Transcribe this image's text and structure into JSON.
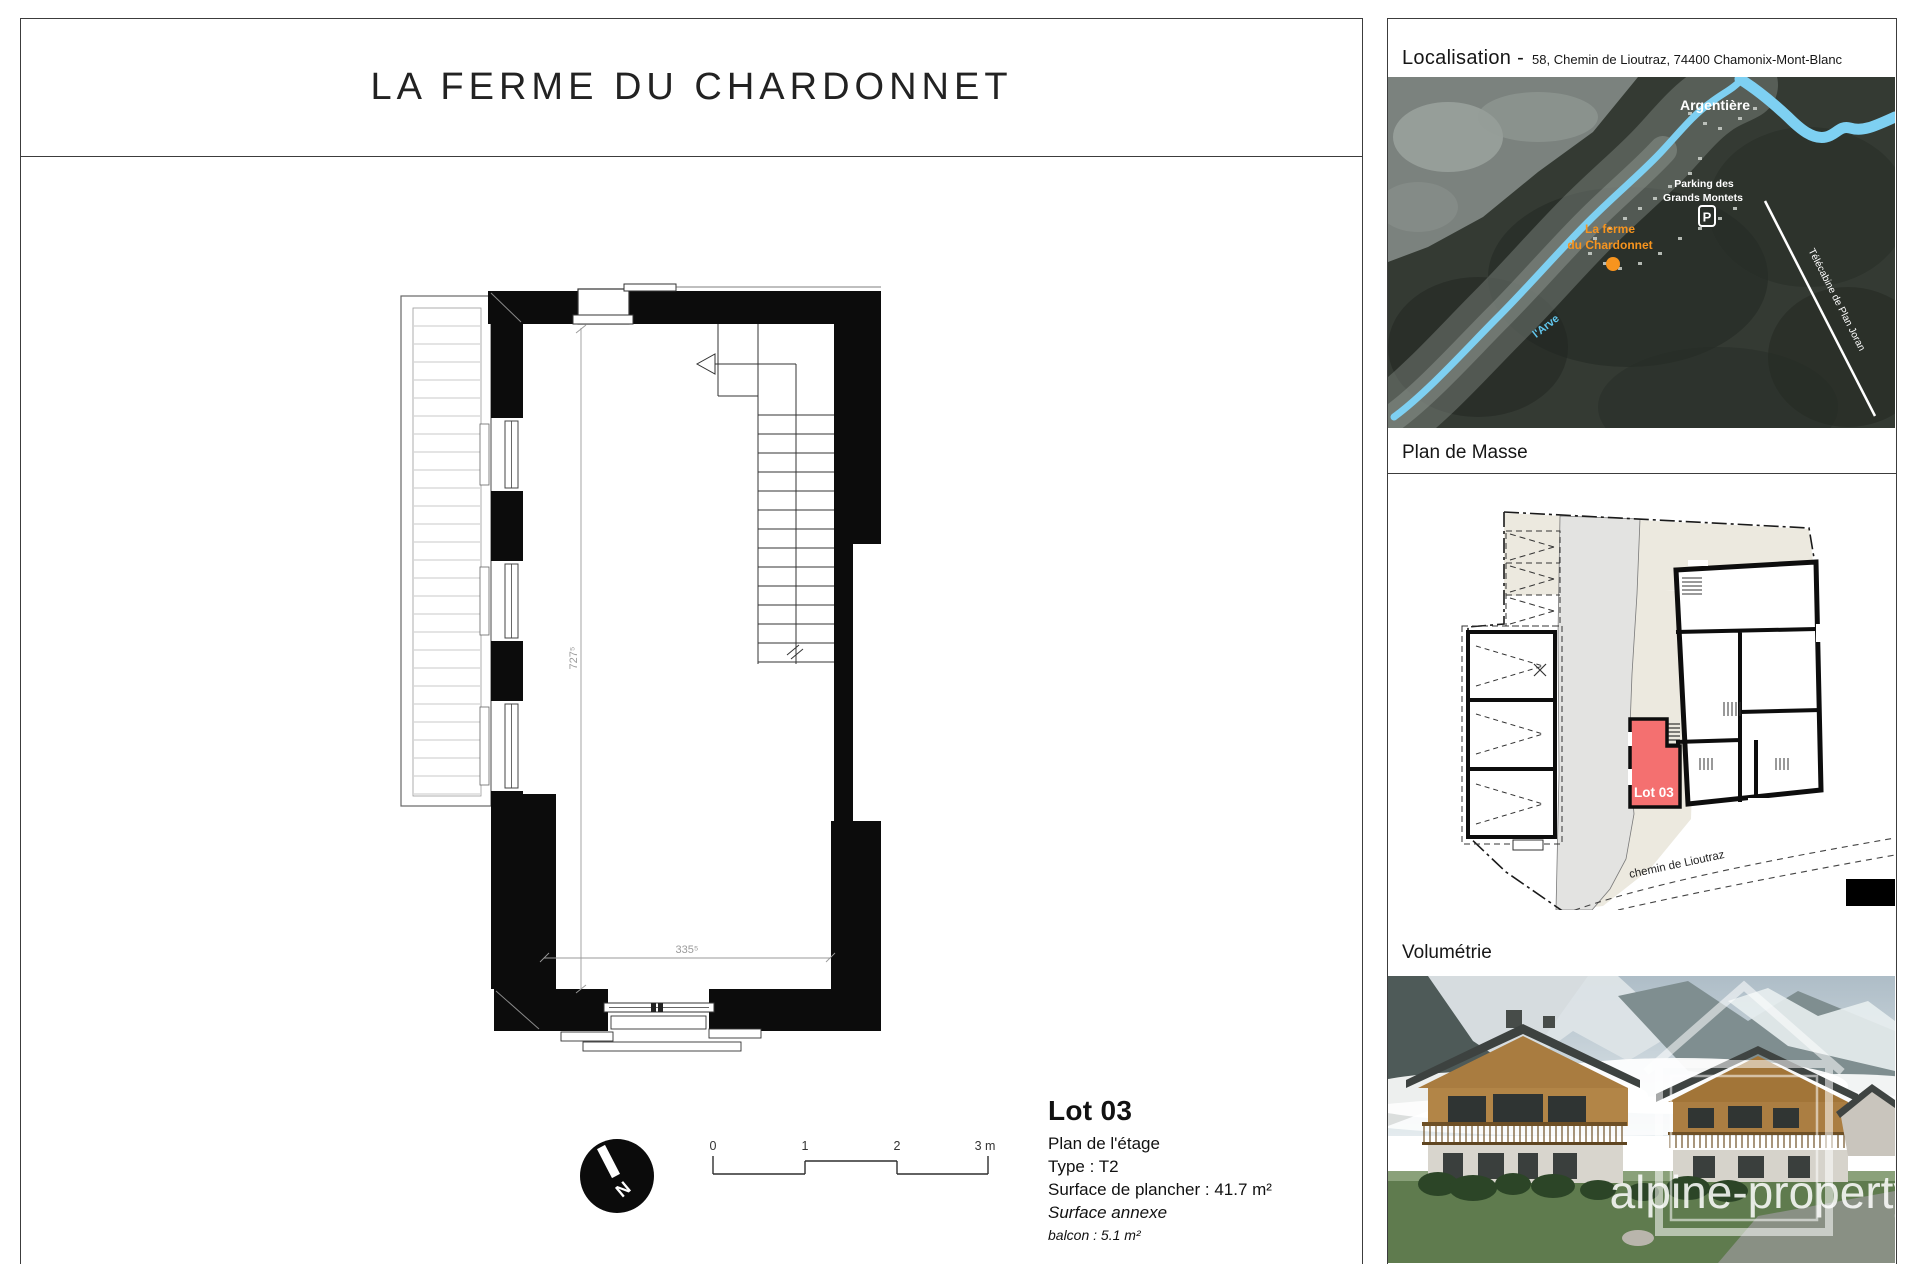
{
  "title": "LA FERME DU CHARDONNET",
  "localisation": {
    "heading": "Localisation -",
    "address": "58, Chemin de Lioutraz, 74400 Chamonix-Mont-Blanc",
    "labels": {
      "town": "Argentière",
      "parking1": "Parking des",
      "parking2": "Grands Montets",
      "parking_icon": "P",
      "site1": "La ferme",
      "site2": "du Chardonnet",
      "river": "l'Arve",
      "lift": "Télécabine de Plan Joran"
    }
  },
  "plan_de_masse": {
    "heading": "Plan de Masse",
    "lot_label": "Lot 03",
    "road_label": "chemin de Lioutraz"
  },
  "volumetrie": {
    "heading": "Volumétrie",
    "watermark": "alpine-property"
  },
  "floor_plan": {
    "dim_vertical": "727⁵",
    "dim_horizontal": "335⁵"
  },
  "north": {
    "label": "N"
  },
  "scale_bar": {
    "ticks": [
      "0",
      "1",
      "2",
      "3 m"
    ]
  },
  "lot_info": {
    "lot": "Lot 03",
    "plan_level": "Plan de l'étage",
    "type": "Type : T2",
    "surface": "Surface de plancher : 41.7 m²",
    "annexe": "Surface annexe",
    "balcony": "balcon : 5.1 m²"
  },
  "colors": {
    "accent_orange": "#F7941E",
    "river_blue": "#7ED0F2",
    "lot_red": "#F47070"
  }
}
